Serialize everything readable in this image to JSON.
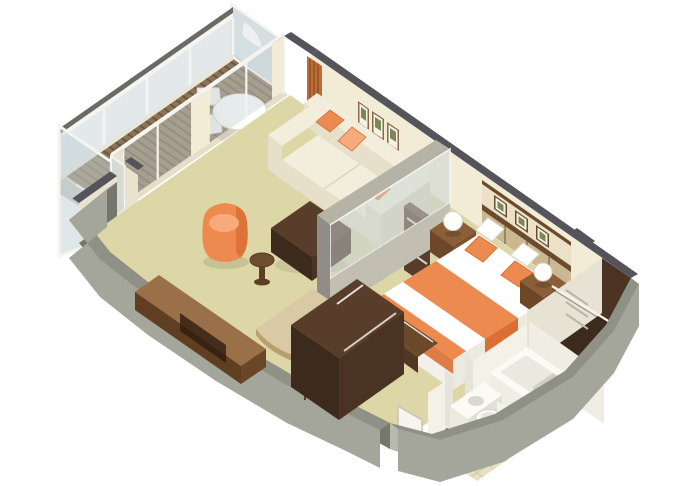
{
  "meta": {
    "kind": "isometric-3d-floorplan-rendering",
    "subject": "cruise-ship-suite-cutaway",
    "width": 680,
    "height": 486
  },
  "palette": {
    "bg": "#ffffff",
    "carpet": "#ddd7a8",
    "deck": "#8b7355",
    "deck_stripe": "#6a563b",
    "glass": "#c7d3d6",
    "glass_frame": "#f4f4f0",
    "rail_dark": "#6a6b66",
    "wall_cream": "#f2ebd5",
    "wall_cream_dim": "#e9e2cc",
    "wall_cap": "#54545a",
    "gray_top": "#8f9086",
    "gray_face": "#a4a59b",
    "gray_inner": "#75766c",
    "gray_inwall": "#b8b9af",
    "gray_light": "#d2d0c6",
    "white": "#fcfbf6",
    "off_white": "#eceade",
    "sofa": "#f3eedb",
    "sofa_shade": "#e6dfc9",
    "sofa_dark": "#dcd5bd",
    "orange": "#ed8a50",
    "orange_dark": "#d96f34",
    "orange_light": "#f7ab7c",
    "curtain": "#bc6c3a",
    "curtain_dark": "#94501f",
    "wood_top": "#573d2a",
    "wood_mid": "#4a3322",
    "wood_dark": "#3c2a1c",
    "console_top": "#9a7048",
    "console_side": "#5f3e22",
    "ns_top": "#8a5f38",
    "ns_front": "#6e4628",
    "ns_side": "#7b5230",
    "headboard": "#6b4a2e",
    "hb_inset": "#eae1c6",
    "hb_panel": "#c9b890",
    "tan": "#d9c9a4",
    "tan_edge": "#b89f72",
    "tile": "#e6e0c4",
    "tile_line": "#cfc9a8",
    "fixture": "#fbfaf4",
    "fixture_shade": "#e5e4da",
    "tub_inner": "#e9e9df",
    "art": "#7a8757",
    "frame_wood": "#8a6a48",
    "partition_gray": "#8f8d85",
    "partition_low": "#c2bfb2",
    "partition_top": "#b5b2a6",
    "divider_face": "#e7e3d4",
    "sill": "#e8e6da"
  },
  "scene": {
    "balcony": {
      "items": [
        "glass-railing",
        "privacy-partition",
        "wood-plank-deck",
        "round-table",
        "deck-chairs",
        "end-side-table"
      ]
    },
    "living_room": {
      "items": [
        "sofa",
        "orange-throw-pillows",
        "wall-art-frames",
        "ottoman-coffee-table",
        "barrel-chair",
        "round-side-table",
        "console-desk",
        "shelf-cabinet",
        "sliding-glass-doors",
        "orange-curtains"
      ]
    },
    "bedroom": {
      "items": [
        "double-bed",
        "orange-bed-runner",
        "orange-pillows",
        "headboard-wall",
        "headboard-art-frames",
        "nightstands",
        "sphere-table-lamps",
        "foot-bench",
        "tv-wardrobe-cabinet",
        "writing-desk",
        "desk-chair",
        "glass-partition"
      ]
    },
    "bathroom": {
      "items": [
        "bathtub",
        "vanity-sink",
        "toilet",
        "tiled-floor",
        "partition-walls"
      ]
    },
    "closet": {
      "items": [
        "walk-in-wardrobe",
        "clothes-rail",
        "shelf-niche"
      ]
    },
    "structure": {
      "items": [
        "curved-hull-wall",
        "exterior-walls",
        "entry-door"
      ]
    }
  }
}
